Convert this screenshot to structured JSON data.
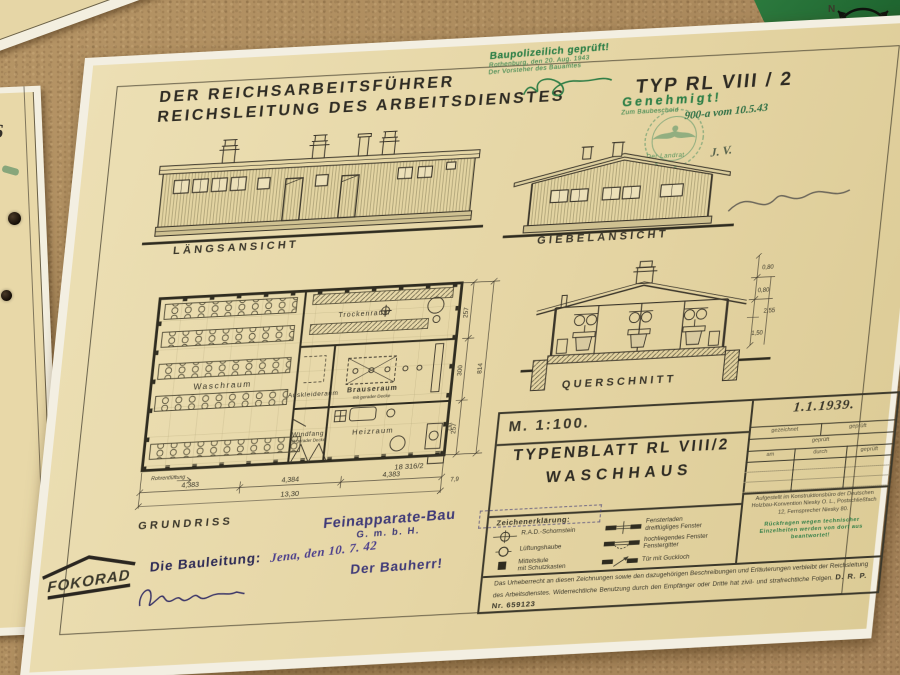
{
  "surroundings": {
    "neighbor_sheet_label": "/6",
    "compass_n": "N",
    "compass_s": "S"
  },
  "header": {
    "line1": "DER REICHSARBEITSFÜHRER",
    "line2": "REICHSLEITUNG DES ARBEITSDIENSTES",
    "type_label": "TYP RL VIII / 2"
  },
  "stamps": {
    "baupolizei_line1": "Baupolizeilich geprüft!",
    "baupolizei_line2": "Rothenburg, den 20. Aug. 1943",
    "baupolizei_line3": "Der Vorsteher des Bauamtes",
    "genehmigt_title": "Genehmigt!",
    "genehmigt_line2": "Zum Baubescheid",
    "genehmigt_hand": "900-a vom 10.5.43",
    "genehmigt_office": "Der Landrat",
    "genehmigt_initials": "J. V."
  },
  "views": {
    "laengsansicht": "LÄNGSANSICHT",
    "giebelansicht": "GIEBELANSICHT",
    "querschnitt": "QUERSCHNITT",
    "grundriss": "GRUNDRISS"
  },
  "plan": {
    "rooms": {
      "waschraum": "Waschraum",
      "trockenraum": "Trockenraum",
      "auskleideraum": "Auskleideraum",
      "brauseraum1": "Brauseraum",
      "brauseraum2": "mit gerader Decke",
      "windfang1": "Windfang",
      "windfang2": "mit gerader Decke",
      "heizraum": "Heizraum"
    },
    "note_vent": "Rohrentlüftung",
    "drawing_no": "18 316/2",
    "dims_bottom": [
      "4,383",
      "4,384",
      "4,383"
    ],
    "dim_total_bottom": "13,30",
    "dim_small": "7,9",
    "dims_right": [
      "257",
      "300",
      "257"
    ],
    "dim_total_right": "814",
    "dim_annex": "2,61"
  },
  "section": {
    "dims": [
      "0,80",
      "0,80",
      "2,55",
      "1,50"
    ]
  },
  "titleblock": {
    "scale": "M. 1:100.",
    "date": "1.1.1939.",
    "drawn_label": "gezeichnet",
    "checked_label": "geprüft",
    "title1": "TYPENBLATT  RL VIII/2",
    "title2": "WASCHHAUS",
    "check_header": "geprüft",
    "check_cols": [
      "am",
      "durch",
      "geprüft"
    ],
    "legend_title": "Zeichenerklärung:",
    "legend_left": [
      "R.A.D.-Schornstein",
      "Lüftungshaube",
      "Mittelsäule\nmit Schutzkasten"
    ],
    "legend_right": [
      "Fensterladen\ndreiflügliges Fenster",
      "hochliegendes Fenster\nFenstergitter",
      "Tür mit Guckloch"
    ],
    "office_note": "Aufgestellt im Konstruktionsbüro der Deutschen Holzbau-Konvention Niesky O. L., Postschließfach 12, Fernsprecher Niesky 80.",
    "office_note_green": "Rückfragen wegen technischer Einzelheiten werden von dort aus beantwortet!",
    "copyright": "Das Urheberrecht an diesen Zeichnungen sowie den dazugehörigen Beschreibungen und Erläuterungen verbleibt der Reichsleitung des Arbeitsdienstes. Widerrechtliche Benutzung durch den Empfänger oder Dritte hat zivil- und strafrechtliche Folgen.",
    "patent": "D. R. P. Nr. 659123"
  },
  "annotations": {
    "firm1": "Feinapparate-Bau",
    "firm2": "G. m. b. H.",
    "hand_date": "Jena, den 10. 7. 42",
    "bauleitung": "Die Bauleitung:",
    "bauherr": "Der Bauherr!",
    "logo": "FOKORAD"
  }
}
